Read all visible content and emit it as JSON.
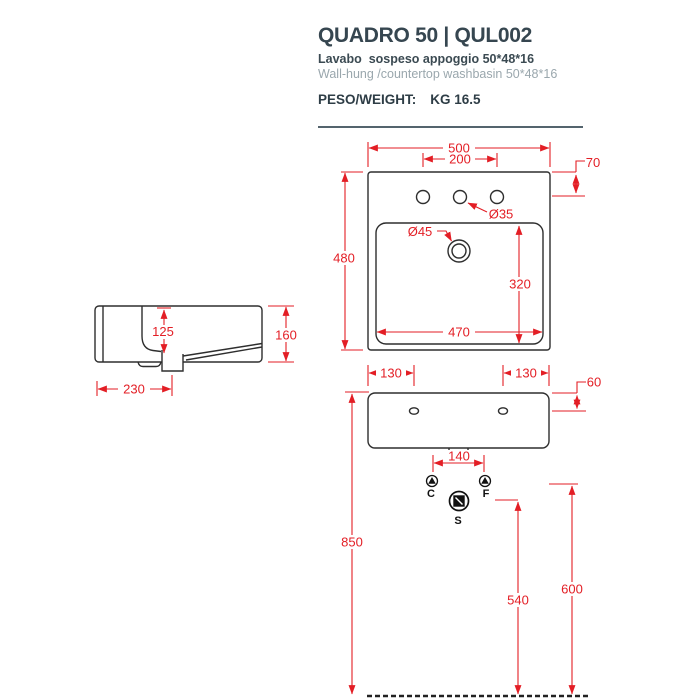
{
  "header": {
    "title": "QUADRO 50 | QUL002",
    "subtitle_it": "Lavabo  sospeso appoggio 50*48*16",
    "subtitle_en": "Wall-hung /countertop washbasin 50*48*16",
    "weight_label": "PESO/WEIGHT:",
    "weight_value": "KG 16.5"
  },
  "colors": {
    "dimension_red": "#e31e25",
    "drawing_line": "#2e2e2e",
    "heading": "#364650",
    "muted_gray": "#9aa7ad"
  },
  "dims": {
    "plan_width": "500",
    "tap_spacing": "200",
    "tap_offset": "70",
    "tap_hole_dia": "Ø35",
    "drain_dia": "Ø45",
    "plan_depth": "480",
    "bowl_depth": "320",
    "bowl_width": "470",
    "side_inner_height": "125",
    "side_height": "160",
    "side_depth": "230",
    "front_hole_left": "130",
    "front_hole_right": "130",
    "front_hole_top": "60",
    "connection_spacing": "140",
    "rim_height": "850",
    "drain_height": "540",
    "supply_height": "600"
  },
  "symbols": {
    "cold": "C",
    "hot": "F",
    "drain": "S"
  }
}
